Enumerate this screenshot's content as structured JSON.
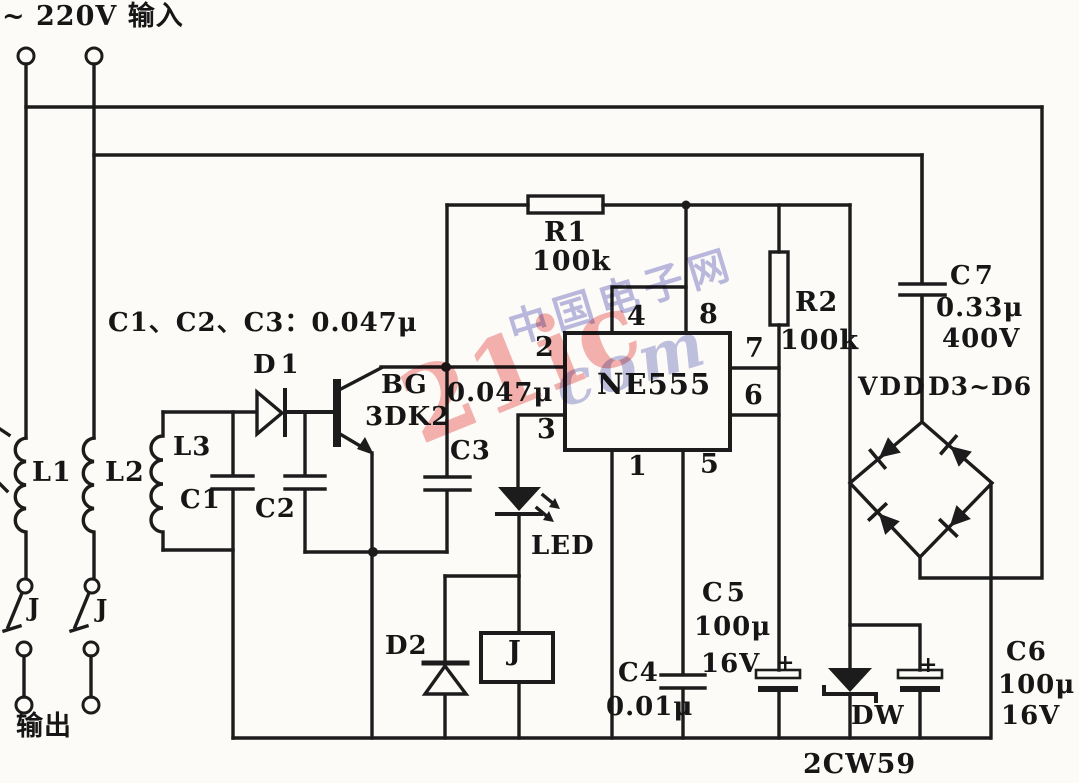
{
  "header": {
    "input_label": "~ 220V 输入",
    "output_label": "输出"
  },
  "caption": "C1、C2、C3：0.047μ",
  "ic": {
    "name": "NE555",
    "pins": {
      "p1": "1",
      "p2": "2",
      "p3": "3",
      "p4": "4",
      "p5": "5",
      "p6": "6",
      "p7": "7",
      "p8": "8"
    }
  },
  "components": {
    "l1": "L1",
    "l2": "L2",
    "l3": "L3",
    "c1": "C1",
    "c2": "C2",
    "c3": "C3",
    "c3_value": "0.047μ",
    "d1": "D1",
    "d2": "D2",
    "bg": "BG",
    "bg_model": "3DK2",
    "r1": "R1",
    "r1_value": "100k",
    "r2": "R2",
    "r2_value": "100k",
    "c7": "C7",
    "c7_value": "0.33μ",
    "c7_voltage": "400V",
    "vdd": "VDD",
    "bridge": "D3~D6",
    "led": "LED",
    "relay": "J",
    "c5": "C5",
    "c5_value": "100μ",
    "c5_voltage": "16V",
    "c4": "C4",
    "c4_value": "0.01μ",
    "c6": "C6",
    "c6_value": "100μ",
    "c6_voltage": "16V",
    "dw": "DW",
    "dw_model": "2CW59",
    "switch1": "J",
    "switch2": "J",
    "plus": "+"
  },
  "watermark": {
    "pink": "21ic",
    "blue_cn": "中国电子网",
    "blue_script": "com"
  }
}
